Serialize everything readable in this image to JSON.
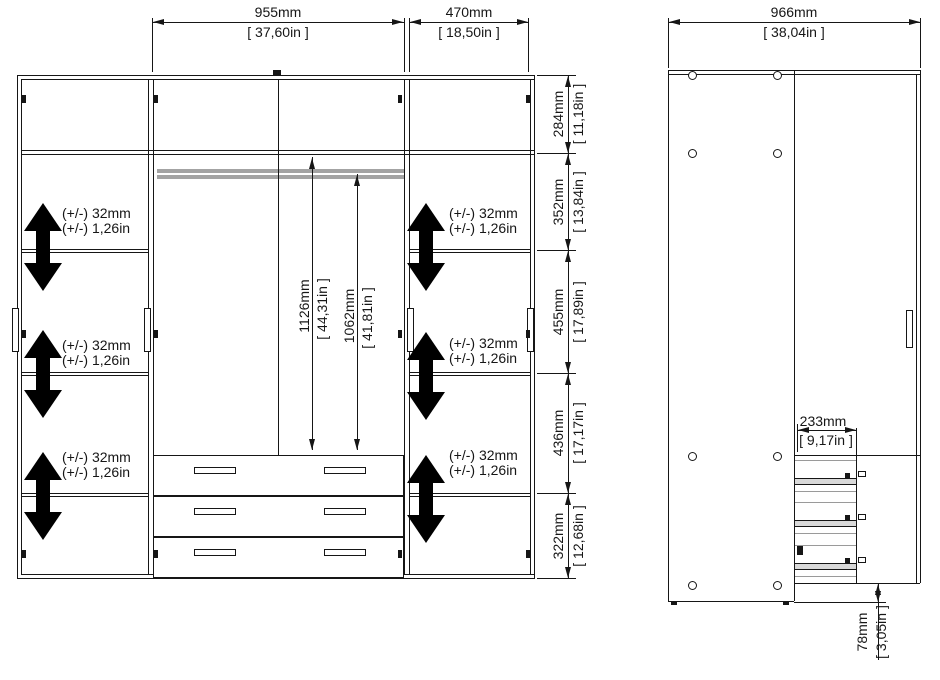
{
  "front_view": {
    "top_width_dims": [
      {
        "mm": "955mm",
        "inches": "[ 37,60in ]"
      },
      {
        "mm": "470mm",
        "inches": "[ 18,50in ]"
      }
    ],
    "right_height_dims": [
      {
        "mm": "284mm",
        "inches": "[ 11,18in ]"
      },
      {
        "mm": "352mm",
        "inches": "[ 13,84in ]"
      },
      {
        "mm": "455mm",
        "inches": "[ 17,89in ]"
      },
      {
        "mm": "436mm",
        "inches": "[ 17,17in ]"
      },
      {
        "mm": "322mm",
        "inches": "[ 12,68in ]"
      }
    ],
    "interior_height_dims": [
      {
        "mm": "1126mm",
        "inches": "[ 44,31in ]"
      },
      {
        "mm": "1062mm",
        "inches": "[ 41,81in ]"
      }
    ],
    "shelf_adjust_label": {
      "line1": "(+/-) 32mm",
      "line2": "(+/-) 1,26in"
    }
  },
  "side_view": {
    "top_width_dim": {
      "mm": "966mm",
      "inches": "[ 38,04in ]"
    },
    "drawer_depth_dim": {
      "mm": "233mm",
      "inches": "[ 9,17in ]"
    },
    "plinth_height_dim": {
      "mm": "78mm",
      "inches": "[ 3,05in ]"
    }
  },
  "colors": {
    "line": "#161616",
    "arrow_black": "#000000",
    "rail_gray": "#a3a3a3",
    "drawer_gray": "#d9d9d9"
  }
}
